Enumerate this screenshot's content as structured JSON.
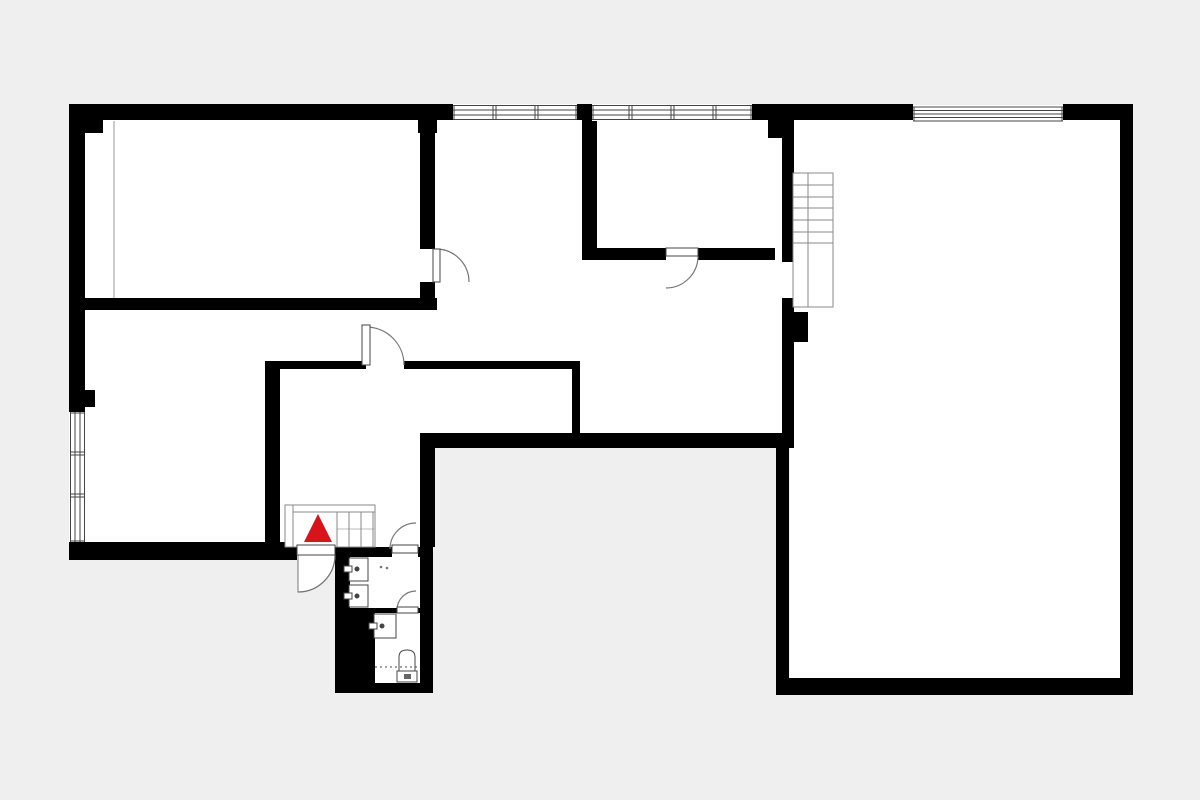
{
  "plan": {
    "canvas": {
      "width": 1200,
      "height": 800,
      "bg": "#efefef",
      "floor": "#ffffff",
      "wall": "#000000",
      "line": "#444444",
      "thin": "#777777",
      "stair_line": "#888888",
      "walkline": "#bbbbbb",
      "accent_red": "#d8141a"
    },
    "floors": [
      {
        "id": "room-top-left-floor",
        "x": 85,
        "y": 119,
        "w": 335,
        "h": 179
      },
      {
        "id": "room-bottom-left-floor",
        "x": 85,
        "y": 310,
        "w": 180,
        "h": 232
      },
      {
        "id": "corridor-connector-floor",
        "x": 265,
        "y": 310,
        "w": 170,
        "h": 51
      },
      {
        "id": "central-area-floor",
        "x": 435,
        "y": 120,
        "w": 347,
        "h": 313
      },
      {
        "id": "hall-upper-floor",
        "x": 280,
        "y": 369,
        "w": 300,
        "h": 64
      },
      {
        "id": "hall-lower-floor",
        "x": 280,
        "y": 433,
        "w": 140,
        "h": 114
      },
      {
        "id": "stair-doorway-opening",
        "x": 782,
        "y": 262,
        "w": 12,
        "h": 36
      },
      {
        "id": "room-right-floor",
        "x": 790,
        "y": 119,
        "w": 330,
        "h": 559
      },
      {
        "id": "doorway-room-top-left",
        "x": 420,
        "y": 249,
        "w": 15,
        "h": 33
      },
      {
        "id": "doorway-hall",
        "x": 366,
        "y": 361,
        "w": 38,
        "h": 8
      },
      {
        "id": "doorway-entrance",
        "x": 297,
        "y": 542,
        "w": 38,
        "h": 18
      }
    ],
    "walls": [
      [
        69,
        104,
        384,
        16
      ],
      [
        577,
        104,
        15,
        16
      ],
      [
        752,
        104,
        161,
        16
      ],
      [
        1063,
        104,
        70,
        16
      ],
      [
        1120,
        104,
        13,
        591
      ],
      [
        776,
        678,
        357,
        17
      ],
      [
        69,
        104,
        16,
        308
      ],
      [
        69,
        542,
        228,
        18
      ],
      [
        83,
        390,
        12,
        17
      ],
      [
        420,
        104,
        15,
        145
      ],
      [
        420,
        282,
        15,
        16
      ],
      [
        69,
        298,
        368,
        12
      ],
      [
        85,
        119,
        18,
        14
      ],
      [
        418,
        119,
        19,
        14
      ],
      [
        582,
        104,
        15,
        149
      ],
      [
        582,
        248,
        84,
        12
      ],
      [
        698,
        248,
        77,
        12
      ],
      [
        768,
        104,
        19,
        34
      ],
      [
        782,
        104,
        12,
        158
      ],
      [
        782,
        298,
        12,
        150
      ],
      [
        788,
        312,
        20,
        30
      ],
      [
        776,
        448,
        13,
        247
      ],
      [
        422,
        433,
        372,
        15
      ],
      [
        265,
        361,
        101,
        8
      ],
      [
        404,
        361,
        176,
        8
      ],
      [
        265,
        361,
        15,
        187
      ],
      [
        572,
        369,
        8,
        64
      ],
      [
        420,
        433,
        15,
        114
      ],
      [
        335,
        547,
        98,
        146
      ]
    ],
    "cutouts": [
      {
        "id": "bathroom-floor",
        "x": 350,
        "y": 557,
        "w": 70,
        "h": 51
      },
      {
        "id": "wc-floor",
        "x": 375,
        "y": 613,
        "w": 45,
        "h": 70
      },
      {
        "id": "doorway-bathroom",
        "x": 392,
        "y": 547,
        "w": 26,
        "h": 10
      },
      {
        "id": "doorway-wc",
        "x": 397,
        "y": 608,
        "w": 21,
        "h": 5
      }
    ],
    "windows": [
      {
        "id": "window-top-left",
        "x": 453,
        "y": 104,
        "w": 124,
        "h": 17,
        "orient": "h",
        "style": "panes",
        "dividers": [
          493,
          535
        ]
      },
      {
        "id": "window-top-mid",
        "x": 592,
        "y": 104,
        "w": 160,
        "h": 17,
        "orient": "h",
        "style": "panes",
        "dividers": [
          629,
          671,
          713
        ]
      },
      {
        "id": "window-room-right",
        "x": 913,
        "y": 105,
        "w": 150,
        "h": 17,
        "orient": "h",
        "style": "lines"
      },
      {
        "id": "window-left-wall",
        "x": 69,
        "y": 412,
        "w": 17,
        "h": 130,
        "orient": "v",
        "style": "panes",
        "dividers": [
          452,
          494
        ]
      }
    ],
    "seams": [
      {
        "x1": 114,
        "y1": 121,
        "x2": 114,
        "y2": 298
      }
    ],
    "doors": [
      {
        "id": "door-room-top-left",
        "leaf": [
          433,
          249,
          7,
          33
        ],
        "arc": "M436,249 A33,33 0 0 1 469,282"
      },
      {
        "id": "door-room-top-mid",
        "leaf": [
          666,
          248,
          32,
          8
        ],
        "arc": "M698,256 A32,32 0 0 1 666,288"
      },
      {
        "id": "door-hall",
        "leaf": [
          362,
          325,
          8,
          40
        ],
        "arc": "M366,327 A38,38 0 0 1 404,365"
      },
      {
        "id": "door-entrance",
        "leaf": [
          297,
          545,
          38,
          10
        ],
        "arc": "M335,555 A37,37 0 0 1 298,592",
        "wedge": "M298,555 L335,555 A37,37 0 0 1 298,592 Z"
      },
      {
        "id": "door-bathroom",
        "leaf": [
          392,
          545,
          26,
          8
        ],
        "arc": "M390,549 A26,26 0 0 1 416,523"
      },
      {
        "id": "door-wc",
        "leaf": [
          397,
          607,
          21,
          6
        ],
        "arc": "M397,610 A19,19 0 0 1 416,591"
      }
    ],
    "stairs": [
      {
        "id": "staircase-entrance",
        "box": [
          285,
          505,
          90,
          42
        ],
        "lines": [
          [
            293,
            505,
            293,
            547
          ],
          [
            293,
            512,
            375,
            512
          ]
        ],
        "walkline": [
          337,
          529,
          375,
          529
        ],
        "treads": {
          "axis": "x",
          "positions": [
            337,
            349,
            361,
            373
          ],
          "from": 512,
          "to": 547
        },
        "triangle": "318,514 304,542 332,542"
      },
      {
        "id": "staircase-main",
        "box": [
          793,
          173,
          40,
          134
        ],
        "lines": [
          [
            808,
            173,
            808,
            307
          ]
        ],
        "treads": {
          "axis": "y",
          "positions": [
            185,
            197,
            208,
            220,
            232,
            243
          ],
          "from": 793,
          "to": 833
        }
      }
    ],
    "fixtures": {
      "sinks": [
        {
          "rect": [
            349,
            558,
            19,
            23
          ],
          "bar": [
            344,
            566,
            8,
            6
          ],
          "dot": [
            357,
            569,
            2.5
          ]
        },
        {
          "rect": [
            349,
            585,
            19,
            22
          ],
          "bar": [
            344,
            593,
            8,
            6
          ],
          "dot": [
            357,
            596,
            2.5
          ]
        },
        {
          "rect": [
            374,
            614,
            22,
            24
          ],
          "bar": [
            369,
            623,
            8,
            6
          ],
          "dot": [
            382,
            626,
            2.5
          ]
        }
      ],
      "toilet": {
        "bowl": "M399,672 L399,657 Q399,650 407,650 Q415,650 415,657 L415,672 Z",
        "cistern": [
          397,
          671,
          20,
          11
        ],
        "mark": [
          404,
          674,
          7,
          5
        ]
      },
      "dashes": [
        {
          "x1": 375,
          "y1": 667,
          "x2": 419,
          "y2": 667
        }
      ],
      "dots": [
        [
          381,
          567,
          1.3
        ],
        [
          387,
          568,
          1.3
        ]
      ]
    }
  }
}
